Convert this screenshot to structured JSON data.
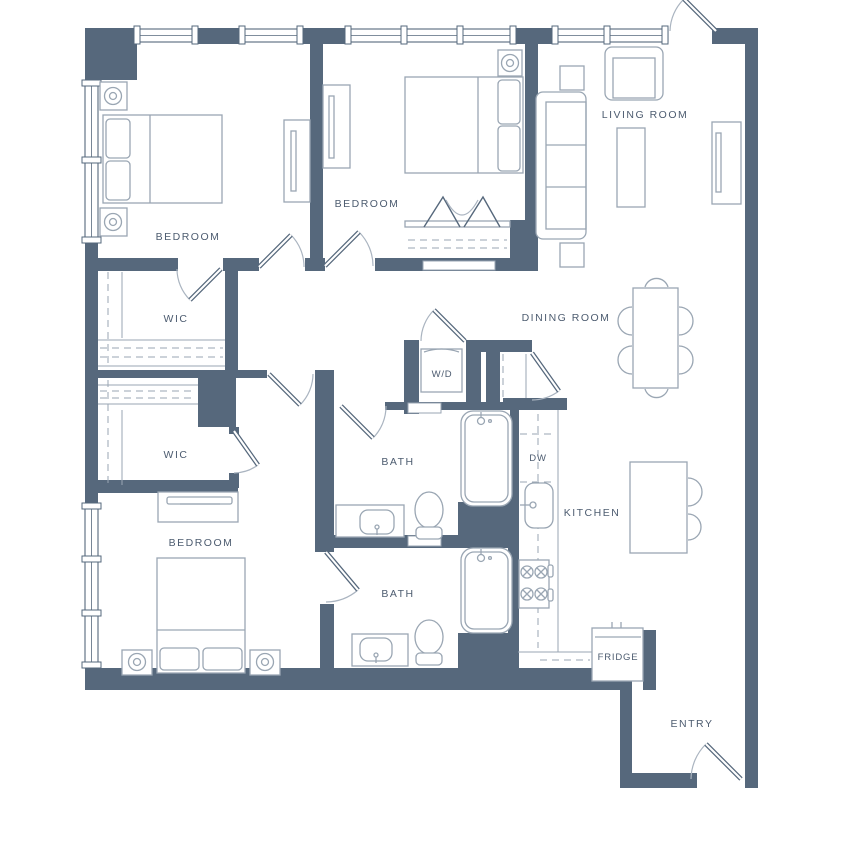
{
  "floorplan": {
    "colors": {
      "wall": "#56687c",
      "furniture": "#9aa6b3",
      "door_arc": "#aab4c0",
      "label": "#4d5c70",
      "background": "#ffffff"
    },
    "rooms": [
      {
        "id": "bedroom-1",
        "label": "BEDROOM"
      },
      {
        "id": "bedroom-2",
        "label": "BEDROOM"
      },
      {
        "id": "living-room",
        "label": "LIVING ROOM"
      },
      {
        "id": "wic-1",
        "label": "WIC"
      },
      {
        "id": "wic-2",
        "label": "WIC"
      },
      {
        "id": "dining-room",
        "label": "DINING ROOM"
      },
      {
        "id": "bath-1",
        "label": "BATH"
      },
      {
        "id": "bath-2",
        "label": "BATH"
      },
      {
        "id": "bedroom-3",
        "label": "BEDROOM"
      },
      {
        "id": "kitchen",
        "label": "KITCHEN"
      },
      {
        "id": "entry",
        "label": "ENTRY"
      }
    ],
    "appliances": [
      {
        "id": "washer-dryer",
        "label": "W/D"
      },
      {
        "id": "dishwasher",
        "label": "DW"
      },
      {
        "id": "fridge",
        "label": "FRIDGE"
      }
    ]
  }
}
